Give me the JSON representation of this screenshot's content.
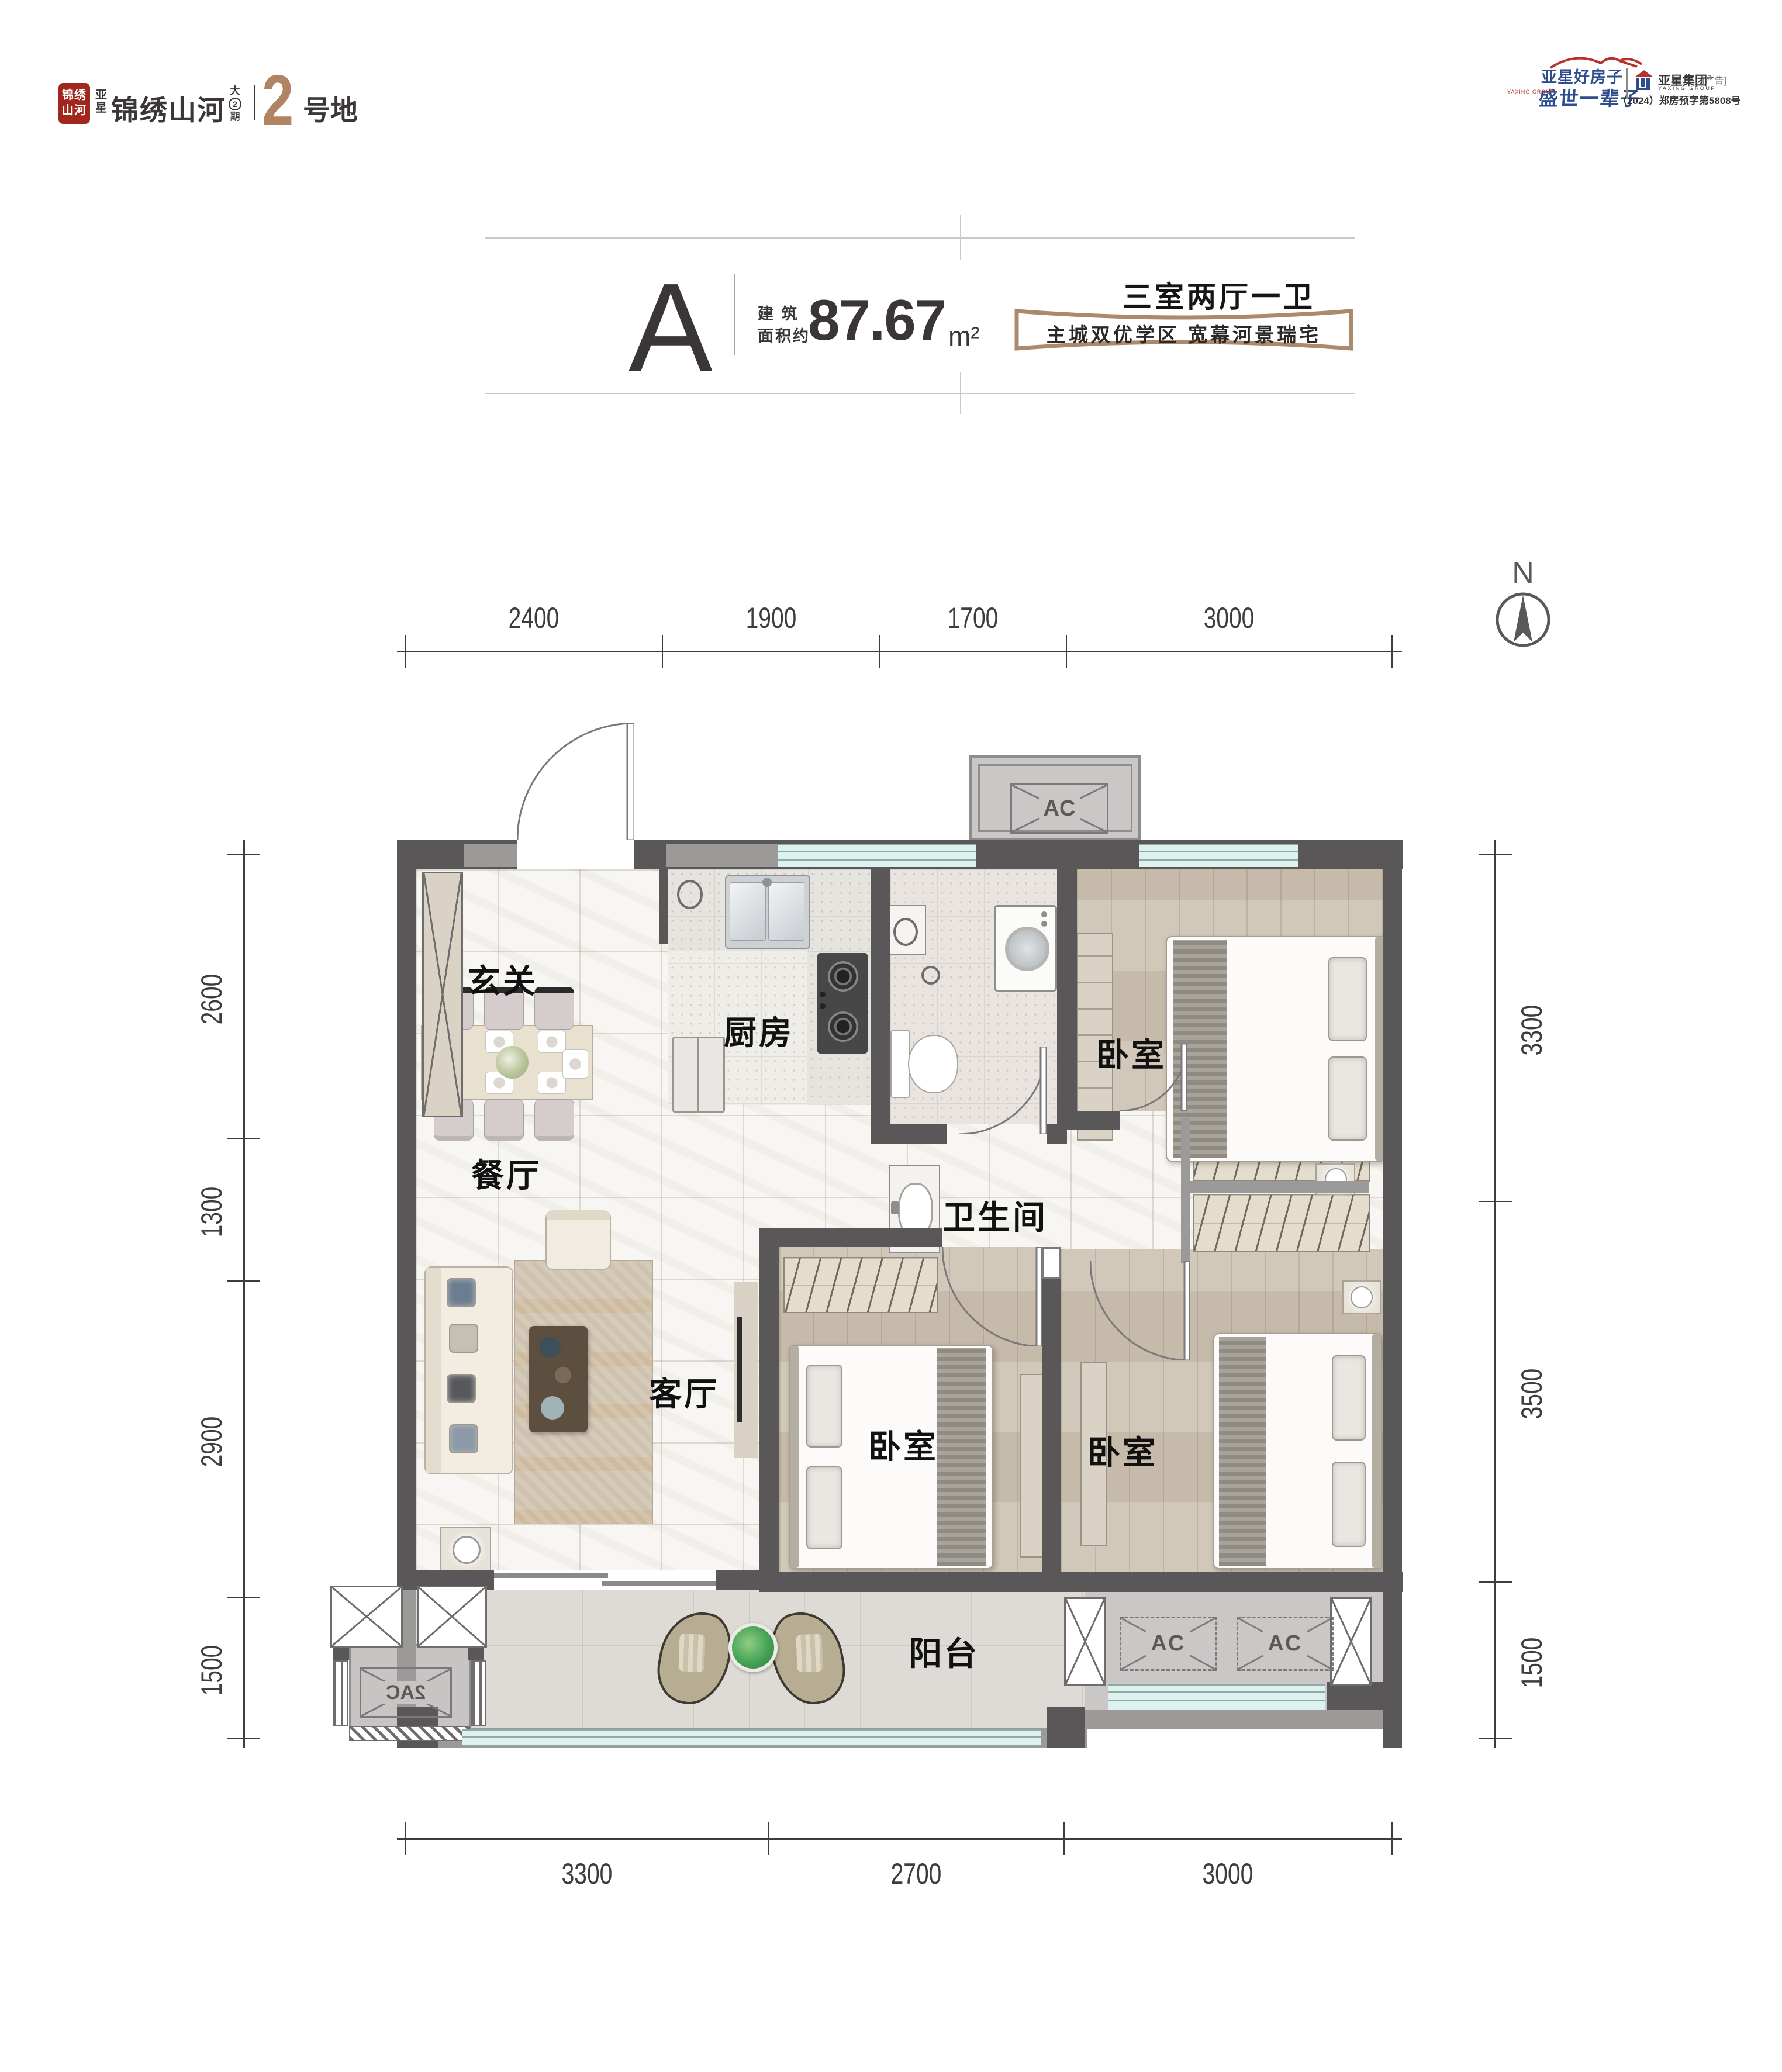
{
  "brand": {
    "seal_text": "锦绣山河",
    "pre": "亚星",
    "name": "锦绣山河",
    "phase_top": "大",
    "phase_num": "2",
    "phase_bottom": "期",
    "plot_num": "2",
    "plot_label": "号地"
  },
  "publisher": {
    "slogan1": "亚星好房子",
    "slogan2": "盛世一辈子",
    "slogan_sub": "YAXING GROUP",
    "group": "亚星集团",
    "reg": "®",
    "ad": "[广告]",
    "group_en": "YAXING GROUP",
    "permit": "（2024）郑房预字第5808号"
  },
  "title": {
    "unit": "A",
    "area_label1": "建 筑",
    "area_label2": "面积约",
    "area_value": "87.67",
    "area_unit": "m²",
    "layout_type": "三室两厅一卫",
    "tagline": "主城双优学区  宽幕河景瑞宅"
  },
  "compass_label": "N",
  "rooms": {
    "foyer": "玄关",
    "kitchen": "厨房",
    "bathroom": "卫生间",
    "bedroom": "卧室",
    "dining": "餐厅",
    "living": "客厅",
    "balcony": "阳台"
  },
  "ac": {
    "label": "AC",
    "label2": "2AC"
  },
  "dimensions": {
    "top": [
      "2400",
      "1900",
      "1700",
      "3000"
    ],
    "bottom": [
      "3300",
      "2700",
      "3000"
    ],
    "left": [
      "2600",
      "1300",
      "2900",
      "1500"
    ],
    "right": [
      "3300",
      "3500",
      "1500"
    ]
  },
  "colors": {
    "wall": "#595757",
    "wall_light": "#9b9a98",
    "window": "#ddf1ef",
    "accent_bronze": "#b08463",
    "brand_red": "#a1261d",
    "brand_blue": "#2e4d8e",
    "wood_floor": "#cdc2b1",
    "marble_floor": "#f7f6f3"
  }
}
